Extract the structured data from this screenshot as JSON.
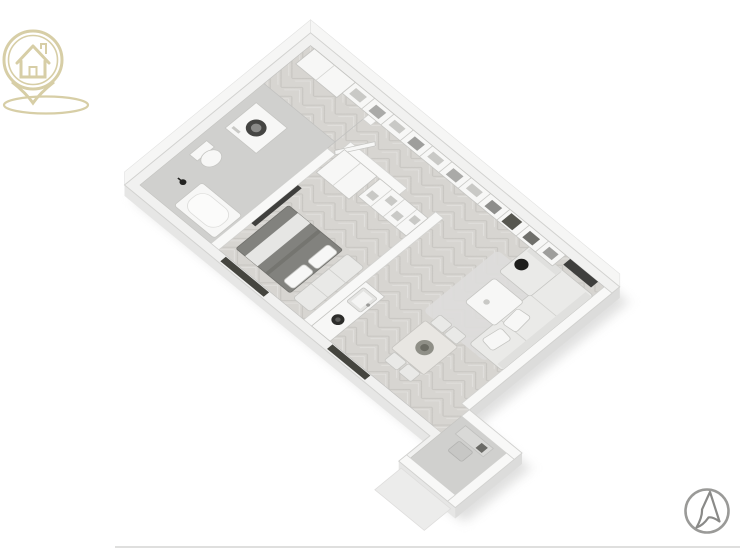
{
  "brand": {
    "logo": "house-location-pin",
    "color": "#d7cea6"
  },
  "controls": {
    "cursor_badge": "navigation-cursor-icon",
    "color": "#8f8f8d"
  },
  "floor_plan": {
    "type": "isometric 3d apartment floor plan",
    "floors": [
      "herringbone wood",
      "gray tile"
    ],
    "rooms": [
      {
        "name": "bathroom",
        "furniture": [
          "bathtub",
          "shower-fixture",
          "toilet",
          "washing-machine",
          "door"
        ]
      },
      {
        "name": "bedroom",
        "furniture": [
          "double-bed",
          "pillows",
          "daybed-bench",
          "wardrobe",
          "storage-cubbies",
          "tv-panel"
        ]
      },
      {
        "name": "kitchen",
        "furniture": [
          "counter",
          "sink",
          "pot-on-cooktop"
        ]
      },
      {
        "name": "living-dining",
        "furniture": [
          "corner-sofa",
          "cushions",
          "coffee-table",
          "rug",
          "floor-lamp",
          "dining-table",
          "chairs",
          "plant-centerpiece",
          "wall-shelving",
          "tv"
        ]
      },
      {
        "name": "entry-vestibule",
        "furniture": [
          "desk",
          "chair",
          "entrance-door",
          "outdoor-step"
        ]
      }
    ],
    "windows": [
      "southwest-wall-bedroom",
      "southwest-wall-living",
      "southeast-wall-living",
      "entry-door-glass"
    ]
  },
  "colors": {
    "bg": "#ffffff",
    "wall": "#f1f1f0",
    "wall-int": "#f8f8f7",
    "wall-face": "#f6f6f5",
    "wall-edge": "#d2d2d0",
    "wood": "#d7d5d1",
    "wood-line": "#bdbbb5",
    "tile": "#d0d0ce",
    "white-f": "#f7f7f6",
    "light-f": "#e9e9e7",
    "mid-f": "#c9c9c6",
    "dark-f": "#3f3f3d",
    "bed": "#82827e",
    "bed-shadow": "#6c6c68",
    "sofa": "#eaeae8",
    "window": "#45453f",
    "shadow": "#dcdcdb",
    "extr": "#e6e6e5",
    "extr2": "#dcdcdb",
    "gold": "#d7cea6",
    "icon": "#8f8f8d",
    "edge": "#c5c5c2",
    "divider": "#d9d9d8"
  }
}
